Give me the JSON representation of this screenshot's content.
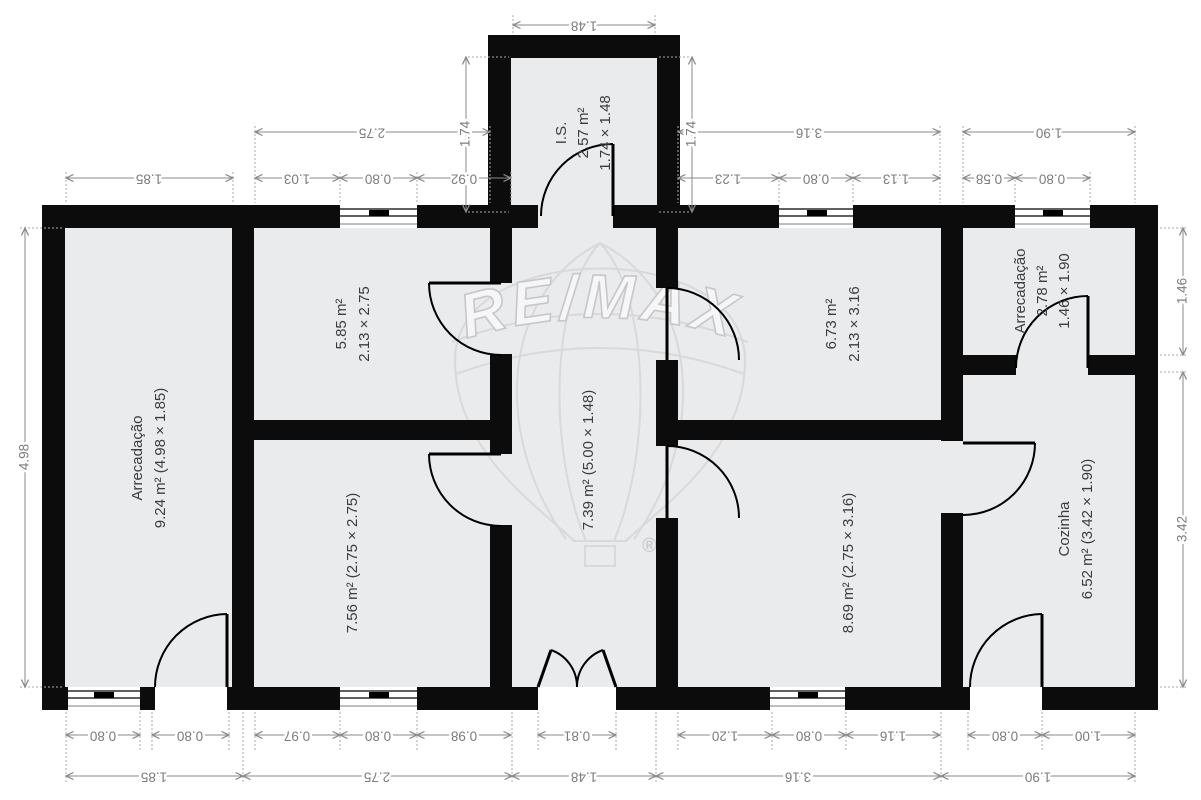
{
  "watermark": {
    "brand": "RE/MAX",
    "registered_mark": "®"
  },
  "rooms": {
    "storage_left": {
      "name": "Arrecadação",
      "details": "9.24 m² (4.98 × 1.85)"
    },
    "bedroom_585": {
      "area": "5.85 m²",
      "size": "2.13 × 2.75"
    },
    "bedroom_756": {
      "details": "7.56 m² (2.75 × 2.75)"
    },
    "wc": {
      "name": "I.S.",
      "area": "2.57 m²",
      "size": "1.74 × 1.48"
    },
    "hallway": {
      "details": "7.39 m² (5.00 × 1.48)"
    },
    "bedroom_673": {
      "area": "6.73 m²",
      "size": "2.13 × 3.16"
    },
    "bedroom_869": {
      "details": "8.69 m² (2.75 × 3.16)"
    },
    "storage_right": {
      "name": "Arrecadação",
      "area": "2.78 m²",
      "size": "1.46 × 1.90"
    },
    "kitchen": {
      "name": "Cozinha",
      "details": "6.52 m² (3.42 × 1.90)"
    }
  },
  "dims": {
    "is_width": "1.48",
    "is_height_l": "1.74",
    "is_height_r": "1.74",
    "r2_275": "2.75",
    "r2_316": "3.16",
    "r2_190": "1.90",
    "r3_185": "1.85",
    "r3_103": "1.03",
    "r3_080a": "0.80",
    "r3_092": "0.92",
    "r3_123": "1.23",
    "r3_080b": "0.80",
    "r3_113": "1.13",
    "r3_058": "0.58",
    "r3_080c": "0.80",
    "bA_080a": "0.80",
    "bA_080b": "0.80",
    "bA_097": "0.97",
    "bA_080c": "0.80",
    "bA_098": "0.98",
    "bA_081": "0.81",
    "bA_120": "1.20",
    "bA_080d": "0.80",
    "bA_116": "1.16",
    "bA_080e": "0.80",
    "bA_100": "1.00",
    "bB_185": "1.85",
    "bB_275": "2.75",
    "bB_148": "1.48",
    "bB_316": "3.16",
    "bB_190": "1.90",
    "left_498": "4.98",
    "right_146": "1.46",
    "right_342": "3.42"
  }
}
